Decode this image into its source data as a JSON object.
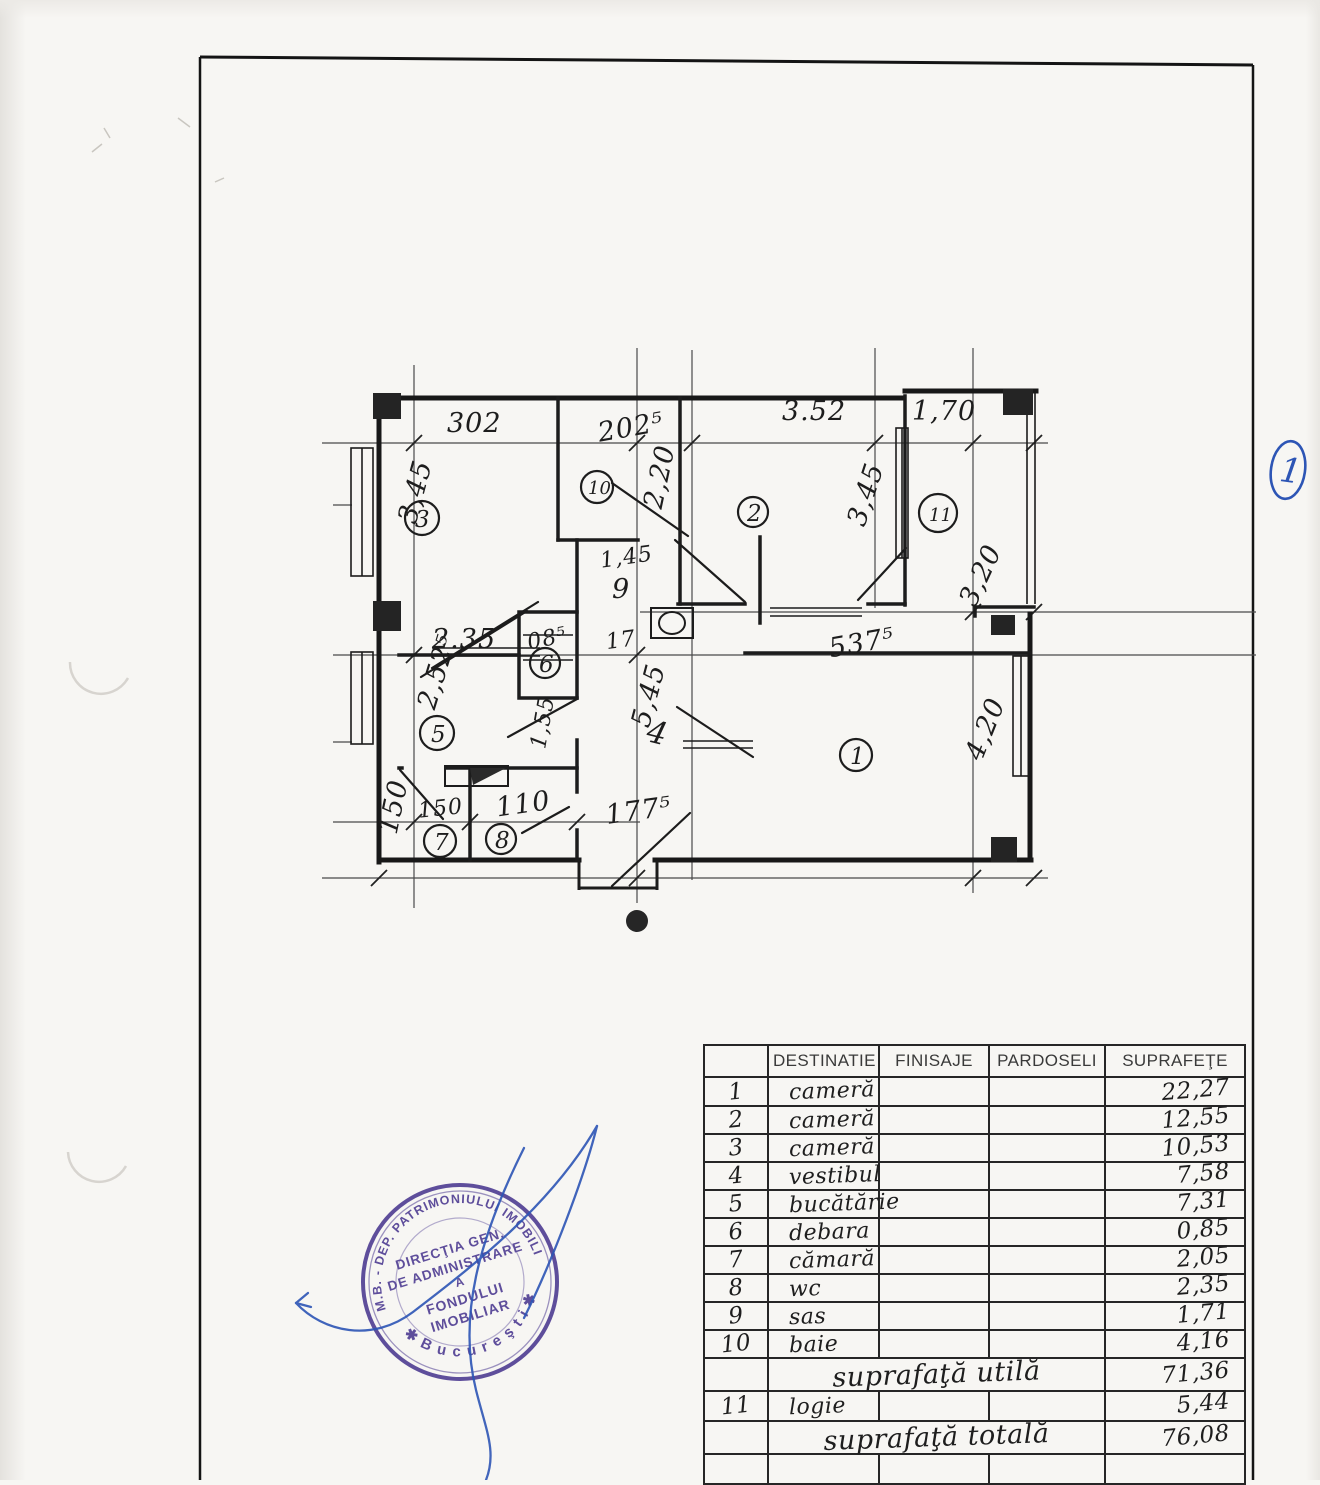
{
  "page": {
    "mark": "1"
  },
  "plan": {
    "dims": {
      "top_302": "302",
      "top_2025": "202⁵",
      "top_352": "3.52",
      "top_170": "1,70",
      "left_345": "3,45",
      "left_2525": "2,52⁵",
      "left_150": "150",
      "mid_235": "2.35",
      "mid_085": "08⁵",
      "mid_17": "17",
      "mid_145": "1,45",
      "mid_9": "9",
      "mid_545": "5,45",
      "mid_5375": "537⁵",
      "mid_4": "4",
      "right_345": "3,45",
      "right_320": "3,20",
      "right_220": "2,20",
      "right_420": "4,20",
      "bot_150": "150",
      "bot_110": "110",
      "bot_1775": "177⁵",
      "deb_155": "1,55"
    },
    "rooms": {
      "r1": "1",
      "r2": "2",
      "r3": "3",
      "r5": "5",
      "r6": "6",
      "r7": "7",
      "r8": "8",
      "r10": "10",
      "r11": "11"
    }
  },
  "table": {
    "headers": [
      "DESTINATIE",
      "FINISAJE",
      "PARDOSELI",
      "SUPRAFEŢE"
    ],
    "rows": [
      {
        "no": "1",
        "dest": "cameră",
        "val": "22,27"
      },
      {
        "no": "2",
        "dest": "cameră",
        "val": "12,55"
      },
      {
        "no": "3",
        "dest": "cameră",
        "val": "10,53"
      },
      {
        "no": "4",
        "dest": "vestibul",
        "val": "7,58"
      },
      {
        "no": "5",
        "dest": "bucătărie",
        "val": "7,31"
      },
      {
        "no": "6",
        "dest": "debara",
        "val": "0,85"
      },
      {
        "no": "7",
        "dest": "cămară",
        "val": "2,05"
      },
      {
        "no": "8",
        "dest": "wc",
        "val": "2,35"
      },
      {
        "no": "9",
        "dest": "sas",
        "val": "1,71"
      },
      {
        "no": "10",
        "dest": "baie",
        "val": "4,16"
      }
    ],
    "util": {
      "label": "suprafaţă utilă",
      "val": "71,36"
    },
    "row11": {
      "no": "11",
      "dest": "logie",
      "val": "5,44"
    },
    "total": {
      "label": "suprafaţă totală",
      "val": "76,08"
    }
  },
  "stamp": {
    "ring_top": "P.M.B. - DEP. PATRIMONIULUI IMOBILIAR",
    "ring_bottom": "✱   B u c u r e ş t i   ✱",
    "line1": "DIRECŢIA GEN.",
    "line2": "DE ADMINISTRARE",
    "line3": "A",
    "line4": "FONDULUI",
    "line5": "IMOBILIAR"
  },
  "colors": {
    "ink": "#1b1b1b",
    "stamp_purple": "#4a3790",
    "pen_blue": "#2d55b5"
  }
}
